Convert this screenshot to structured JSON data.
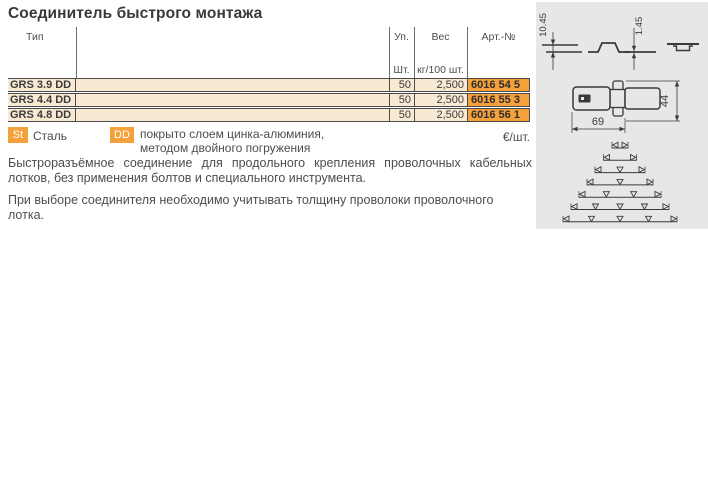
{
  "page": {
    "title": "Соединитель быстрого монтажа"
  },
  "table": {
    "headers": {
      "type": "Тип",
      "pack": "Уп.",
      "weight": "Вес",
      "art_no": "Арт.-№",
      "pack_unit": "Шт.",
      "weight_unit": "кг/100 шт."
    },
    "rows": [
      {
        "type": "GRS 3.9 DD",
        "pack": "50",
        "weight": "2,500",
        "art_no": "6016 54 5"
      },
      {
        "type": "GRS 4.4 DD",
        "pack": "50",
        "weight": "2,500",
        "art_no": "6016 55 3"
      },
      {
        "type": "GRS 4.8 DD",
        "pack": "50",
        "weight": "2,500",
        "art_no": "6016 56 1"
      }
    ]
  },
  "legend": {
    "steel_code": "St",
    "steel_label": "Сталь",
    "coating_code": "DD",
    "coating_line1": "покрыто слоем цинка-алюминия,",
    "coating_line2": "методом двойного погружения",
    "price_unit": "€/шт."
  },
  "description": {
    "paragraph1": "Быстроразъёмное соединение для продольного крепления проволочных кабельных лотков, без применения болтов и специального инструмента.",
    "paragraph2": "При выборе соединителя необходимо учитывать толщину проволоки проволочного лотка."
  },
  "drawing": {
    "dims": {
      "profile_height": "10.45",
      "thickness": "1.45",
      "length": "69",
      "width": "44"
    },
    "mount_diagram": {
      "center_x": 84,
      "start_y": 146,
      "row_gap": 12.3,
      "stroke": "#3a3a3c",
      "rows": [
        {
          "width": 16,
          "mid_marks": 0
        },
        {
          "width": 33,
          "mid_marks": 0
        },
        {
          "width": 50,
          "mid_marks": 1
        },
        {
          "width": 66,
          "mid_marks": 1
        },
        {
          "width": 82,
          "mid_marks": 2
        },
        {
          "width": 98,
          "mid_marks": 3
        },
        {
          "width": 114,
          "mid_marks": 3
        }
      ]
    }
  },
  "colors": {
    "accent_orange": "#f5a13b",
    "row_beige": "#f8e9d3",
    "panel_gray": "#e7e7e7",
    "border_dark": "#4b4b4d",
    "text_gray": "#4d4d4f"
  }
}
